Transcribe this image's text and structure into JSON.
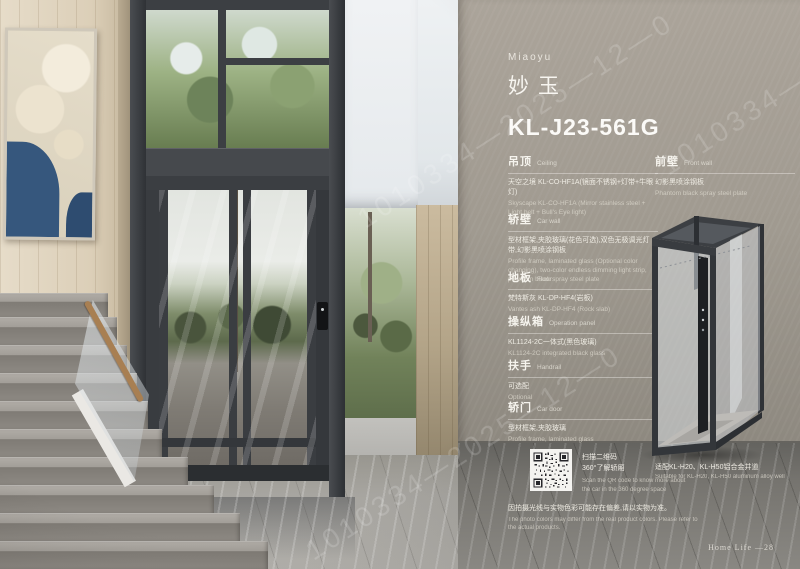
{
  "brand": {
    "name_en": "Miaoyu",
    "name_cn": "妙玉",
    "model": "KL-J23-561G"
  },
  "specs_left": [
    {
      "title_cn": "吊顶",
      "title_en": "Ceiling",
      "body_cn": "天空之境 KL-CO-HF1A(镜面不锈钢+灯带+牛眼灯)",
      "body_en": "Skyscape KL-CO-HF1A (Mirror stainless steel + Light belt + Bull's Eye light)"
    },
    {
      "title_cn": "轿壁",
      "title_en": "Car wall",
      "body_cn": "型材框架,夹胶玻璃(花色可选),双色无极调光灯带,幻影黑喷涂钢板",
      "body_en": "Profile frame, laminated glass (Optional color changing), two-color endless dimming light strip, phantom black spray steel plate"
    },
    {
      "title_cn": "地板",
      "title_en": "Floor",
      "body_cn": "梵特斯灰 KL-DP-HF4(岩板)",
      "body_en": "Vantes ash KL-DP-HF4 (Rock slab)"
    },
    {
      "title_cn": "操纵箱",
      "title_en": "Operation panel",
      "body_cn": "KL1124-2C一体式(黑色玻璃)",
      "body_en": "KL1124-2C integrated black glass"
    },
    {
      "title_cn": "扶手",
      "title_en": "Handrail",
      "body_cn": "可选配",
      "body_en": "Optional"
    },
    {
      "title_cn": "轿门",
      "title_en": "Car door",
      "body_cn": "型材框架,夹胶玻璃",
      "body_en": "Profile frame, laminated glass"
    }
  ],
  "specs_right": [
    {
      "title_cn": "前壁",
      "title_en": "Front wall",
      "body_cn": "幻影黑喷涂钢板",
      "body_en": "Phantom black spray steel plate"
    }
  ],
  "shaft_note": {
    "cn": "适配KL-H20、KL-H50铝合金井道",
    "en": "Suitable for KL-H20, KL-H50 aluminum alloy well"
  },
  "qr_block": {
    "cn1": "扫描二维码",
    "cn2": "360°了解轿厢",
    "en": "Scan the QR code to know more about the car in the 360 degree space"
  },
  "disclaimer": {
    "cn": "因拍摄光线与实物色彩可能存在偏差,请以实物为准。",
    "en": "The photo colors may differ from the real product colors. Please refer to the actual products."
  },
  "footer": {
    "page": "Home Life —28"
  },
  "watermark": {
    "text": "1010334—2025—12—0"
  },
  "colors": {
    "panel_wall": "#a09a90",
    "frame_charcoal": "#3a3d41",
    "text_light": "#f3f1ea"
  }
}
